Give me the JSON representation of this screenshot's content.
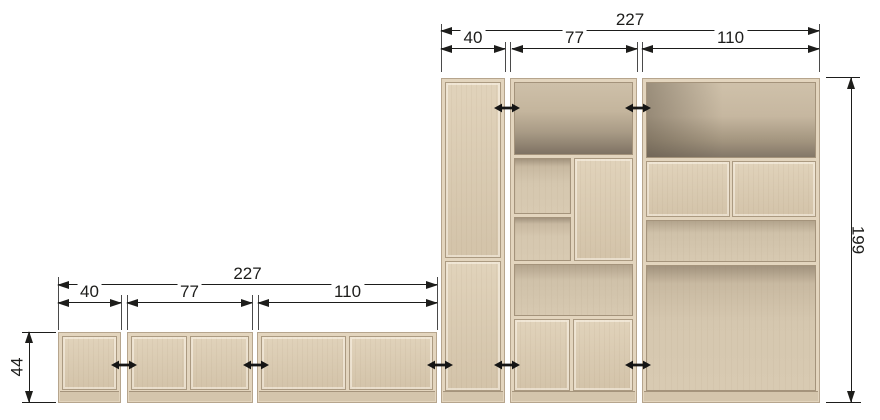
{
  "dimensions": {
    "top": {
      "total": "227",
      "seg1": "40",
      "seg2": "77",
      "seg3": "110"
    },
    "bottom": {
      "total": "227",
      "seg1": "40",
      "seg2": "77",
      "seg3": "110"
    },
    "low_unit_height": "44",
    "tall_unit_height": "199"
  },
  "icons": {
    "door_opening": "double-arrow-icon"
  },
  "colors": {
    "background": "#ffffff",
    "wood": "#d9cab2",
    "wood_interior_shadow": "#7e7263",
    "dimension_line": "#1d1d1b"
  }
}
